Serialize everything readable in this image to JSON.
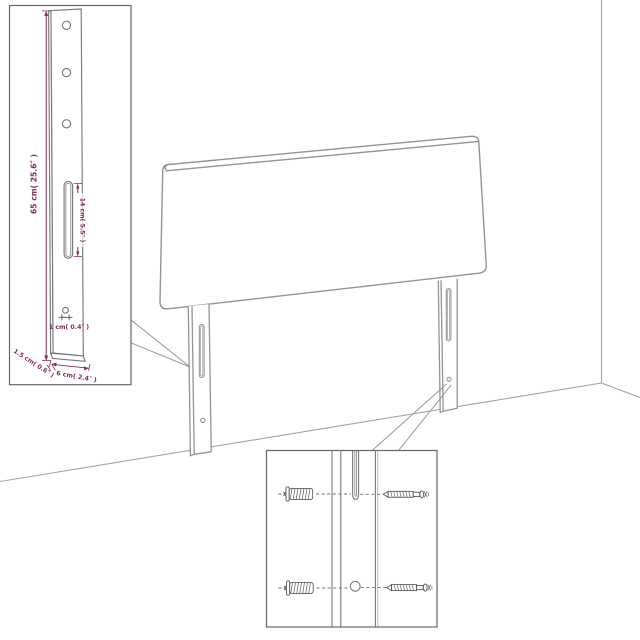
{
  "colors": {
    "dimension": "#832a56",
    "outline_gray": "#949494",
    "inset_content_gray": "#7a7a7a",
    "inset_border": "#666666",
    "hardware_gray": "#5a5a5a",
    "background": "#ffffff"
  },
  "leg_detail_inset": {
    "labels": {
      "height": "65 cm( 25.6″ )",
      "slot_length": "14 cm( 5.5″ )",
      "hole_diameter": "1 cm( 0.4″ )",
      "thickness": "1.5 cm( 0.6″ )",
      "width": "6 cm( 2.4″ )"
    }
  },
  "hardware_inset": {
    "parts": [
      "wall-plug",
      "screw",
      "leg-slot",
      "mounting-hole"
    ]
  }
}
